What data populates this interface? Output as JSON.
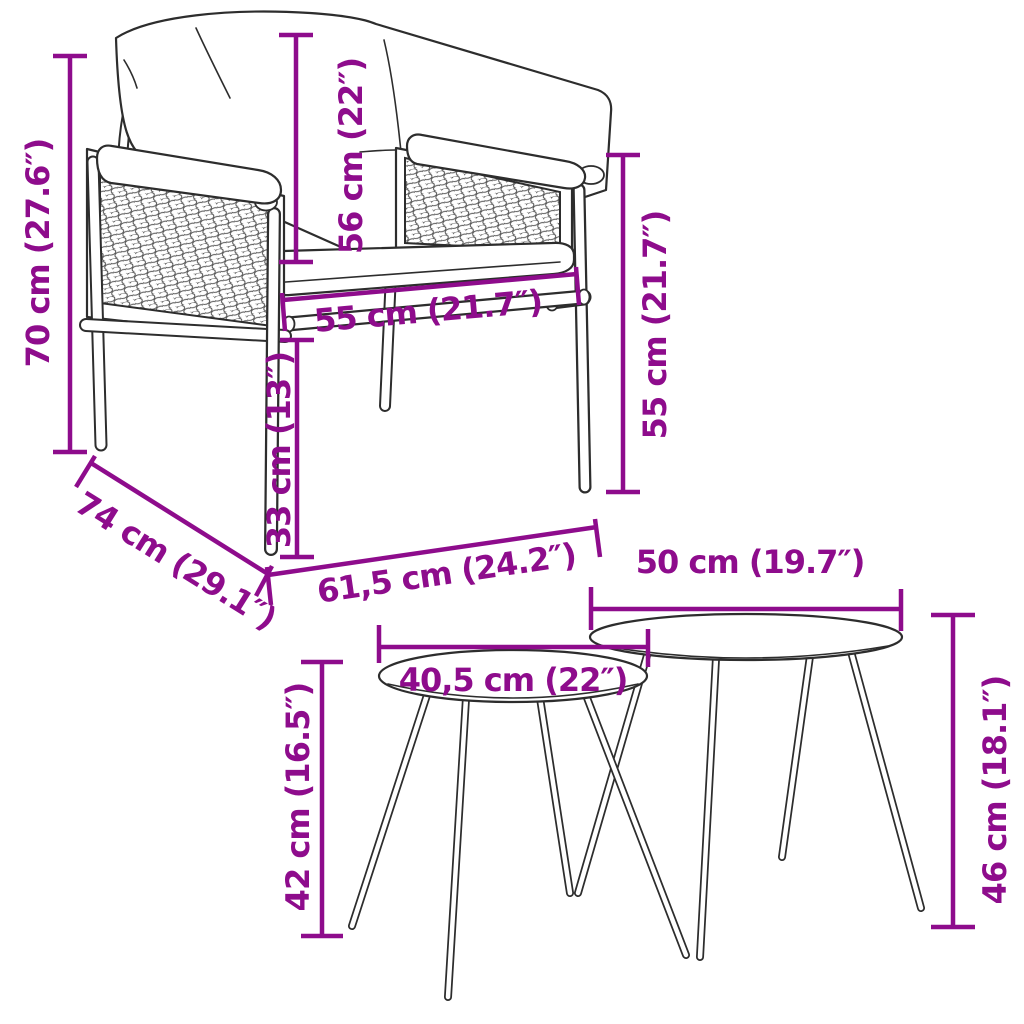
{
  "figure": {
    "kind": "product-dimension-diagram",
    "subject": "garden chair with cushions and two round nesting side tables",
    "accent_color": "#8E0C8C",
    "line_color": "#2D2D2D",
    "background": "#FFFFFF"
  },
  "dims": {
    "chair_height": "70 cm (27.6″)",
    "back_cushion_height": "56 cm (22″)",
    "seat_width": "55 cm (21.7″)",
    "seat_height": "33 cm (13″)",
    "chair_depth": "74 cm (29.1″)",
    "chair_width": "61,5 cm (24.2″)",
    "armrest_height": "55 cm (21.7″)",
    "small_table_diameter": "40,5 cm (22″)",
    "large_table_diameter": "50 cm (19.7″)",
    "small_table_height": "42 cm (16.5″)",
    "large_table_height": "46 cm (18.1″)"
  }
}
